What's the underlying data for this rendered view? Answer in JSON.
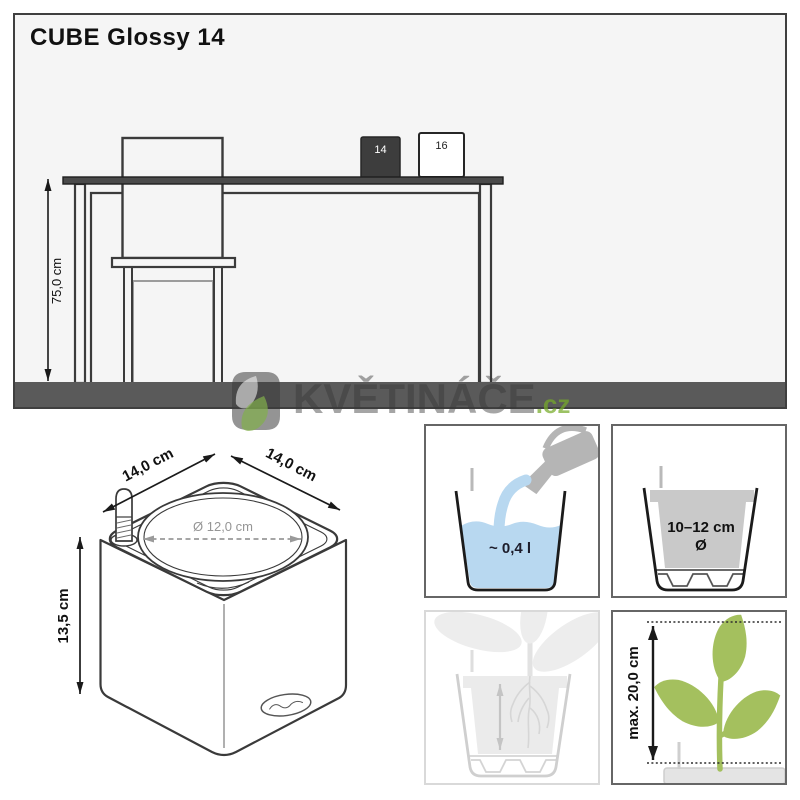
{
  "title": "CUBE Glossy 14",
  "scene": {
    "desk_height_label": "75,0 cm",
    "cube_small_label": "14",
    "cube_large_label": "16"
  },
  "watermark": {
    "text": "KVĚTINÁČE",
    "suffix": ".cz"
  },
  "product_drawing": {
    "width_left": "14,0 cm",
    "width_right": "14,0 cm",
    "opening_diameter": "Ø 12,0 cm",
    "height": "13,5 cm"
  },
  "info_boxes": {
    "water_volume": {
      "label": "~ 0,4 l"
    },
    "inner_pot": {
      "diameter_range": "10–12 cm",
      "diameter_symbol": "Ø"
    },
    "plant_height": {
      "label": "max. 20,0 cm"
    }
  },
  "colors": {
    "floor_gray": "#5a5a5a",
    "tabletop_gray": "#4a4a4a",
    "outline_dark": "#3a3a3a",
    "water_blue": "#b8d8f0",
    "watering_can_gray": "#b5b5b5",
    "inner_pot_gray": "#c9c9c9",
    "plant_green": "#a4c05e",
    "watermark_green": "#8fbf4d",
    "faded_gray": "#d6d6d6"
  }
}
